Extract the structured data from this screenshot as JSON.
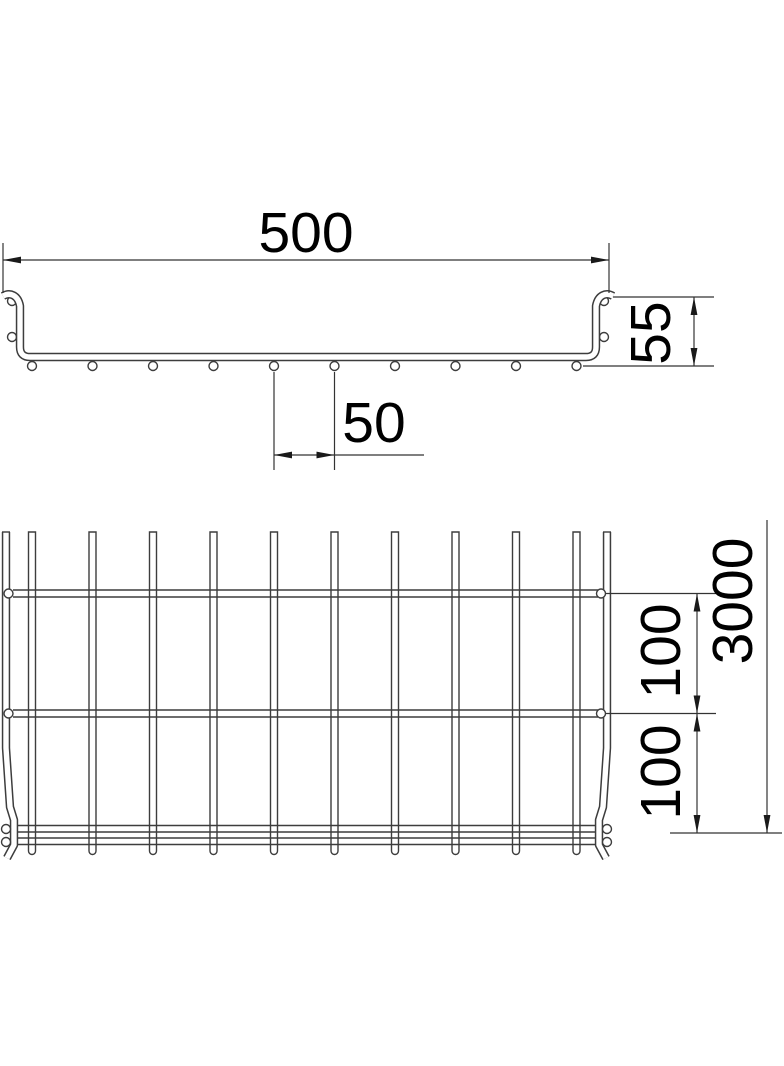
{
  "drawing_title": "Mesh cable tray dimensional drawing",
  "cross_section": {
    "width": "500",
    "height": "55",
    "wire_spacing": "50"
  },
  "plan": {
    "rung_spacing_top": "100",
    "rung_spacing_bottom": "100",
    "length": "3000"
  },
  "colors": {
    "background": "#ffffff",
    "line": "#3d3d3d",
    "dimension_line": "#333333",
    "text": "#000000"
  }
}
